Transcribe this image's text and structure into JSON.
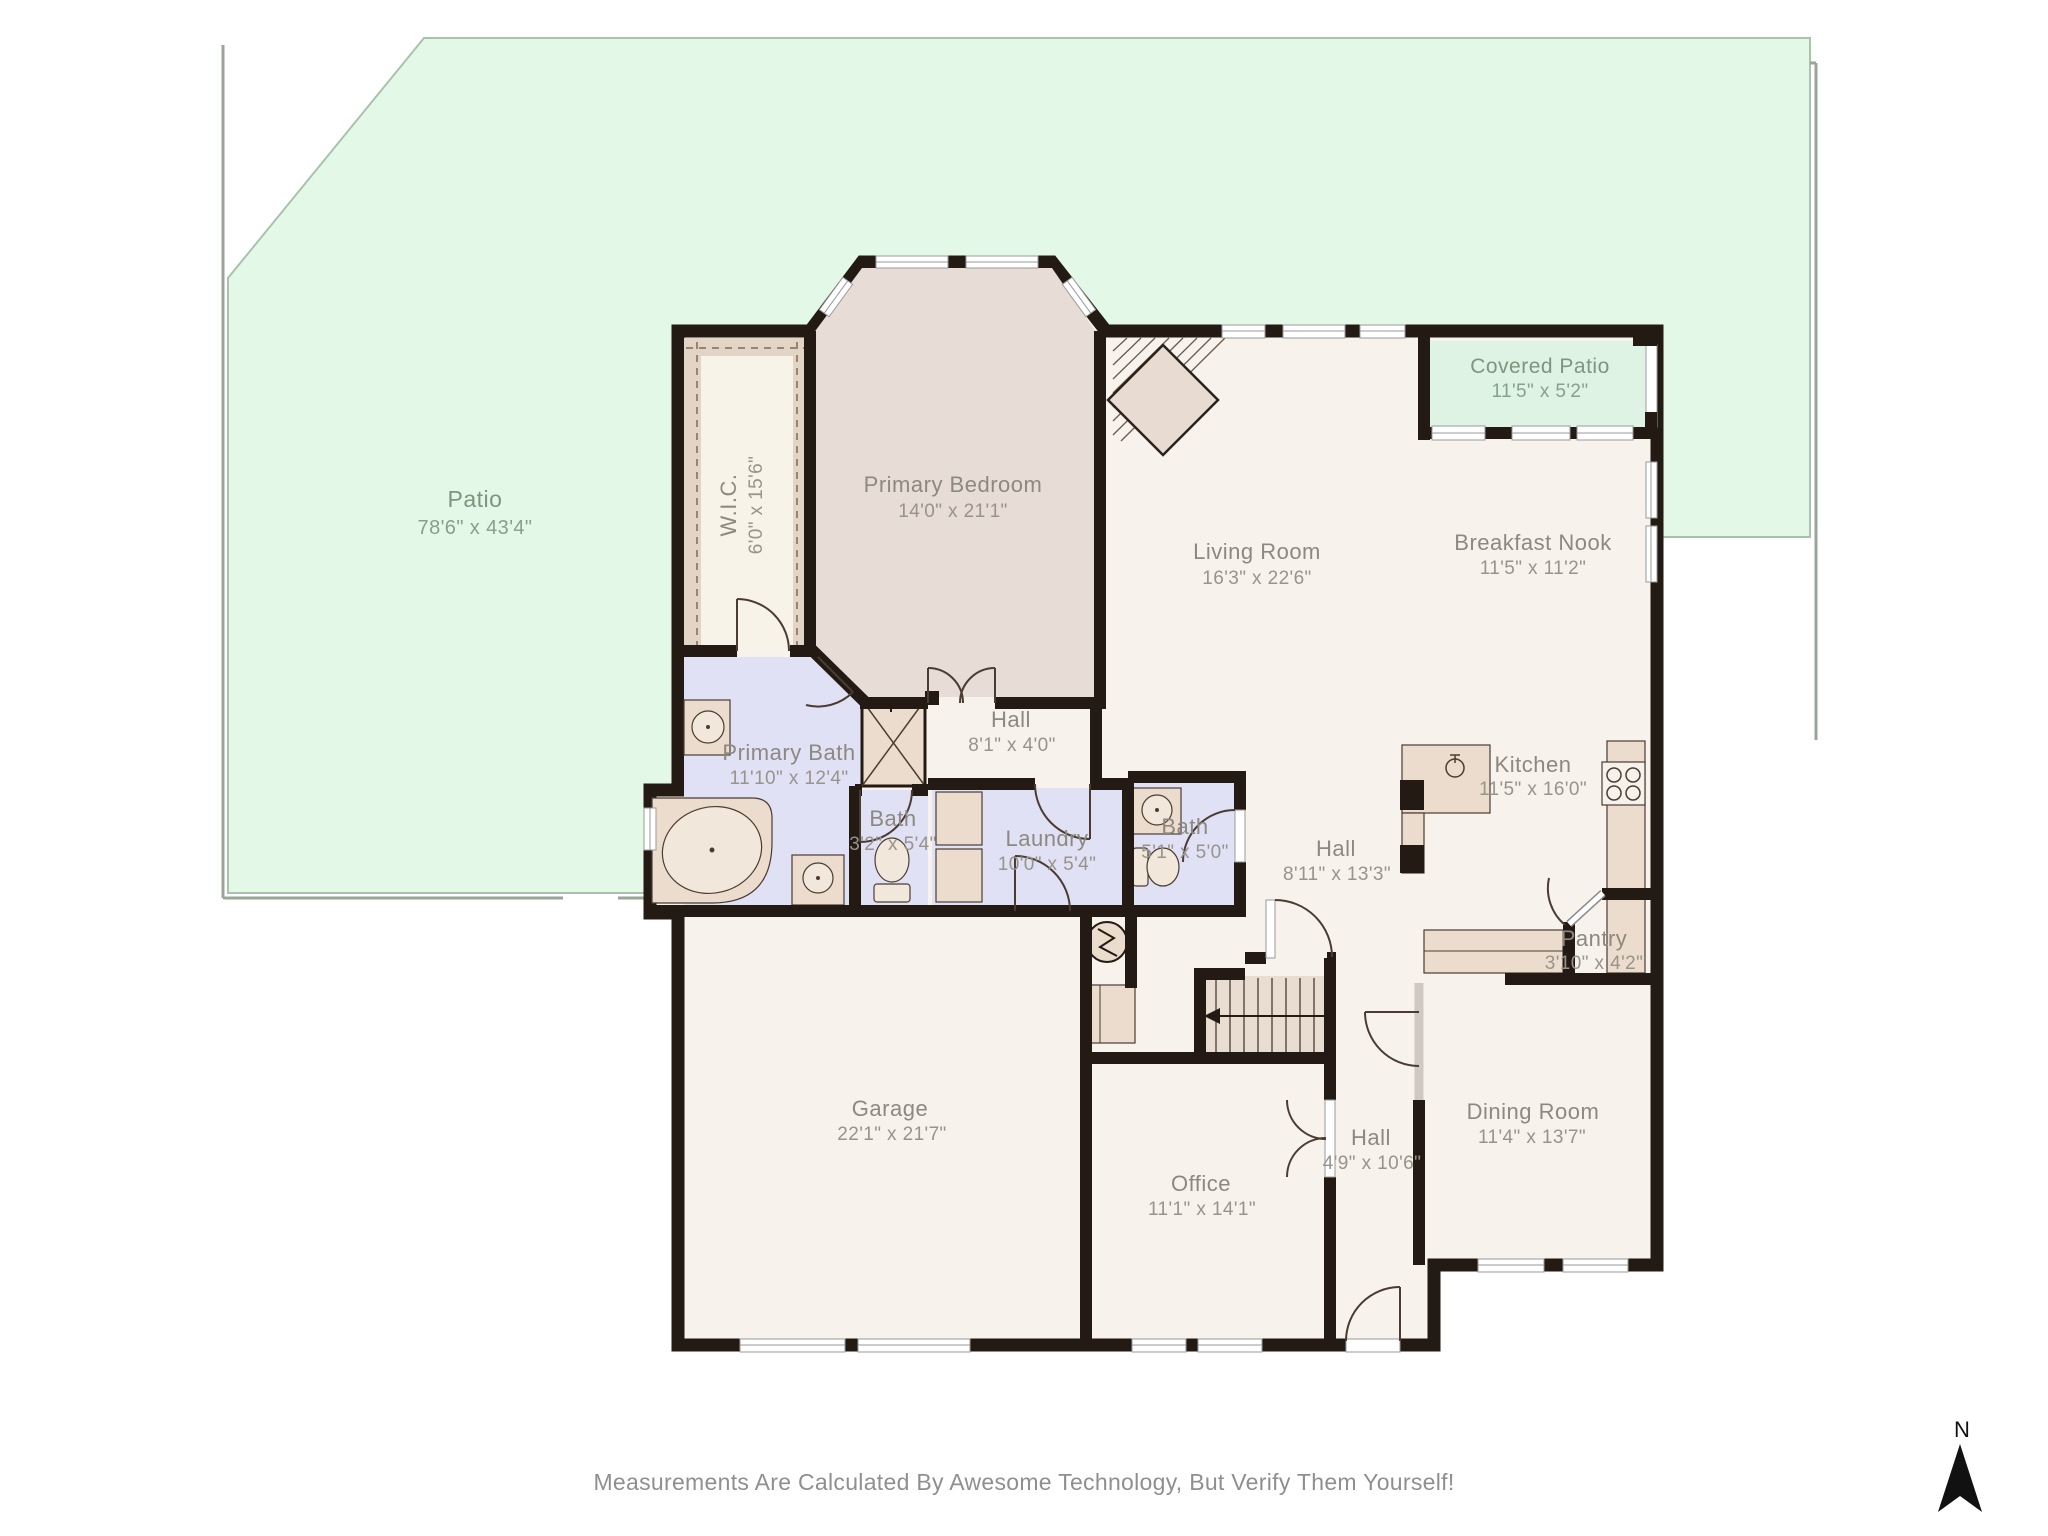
{
  "footer": {
    "disclaimer": "Measurements Are Calculated By Awesome Technology, But Verify Them Yourself!"
  },
  "compass": {
    "label": "N"
  },
  "rooms": {
    "patio": {
      "name": "Patio",
      "dims": "78'6\" x 43'4\""
    },
    "covered_patio": {
      "name": "Covered Patio",
      "dims": "11'5\" x 5'2\""
    },
    "wic": {
      "name": "W.I.C.",
      "dims": "6'0\" x 15'6\""
    },
    "primary_bedroom": {
      "name": "Primary Bedroom",
      "dims": "14'0\" x 21'1\""
    },
    "living_room": {
      "name": "Living Room",
      "dims": "16'3\" x 22'6\""
    },
    "breakfast_nook": {
      "name": "Breakfast Nook",
      "dims": "11'5\" x 11'2\""
    },
    "primary_bath": {
      "name": "Primary Bath",
      "dims": "11'10\" x 12'4\""
    },
    "hall_1": {
      "name": "Hall",
      "dims": "8'1\" x 4'0\""
    },
    "bath_1": {
      "name": "Bath",
      "dims": "3'2\" x 5'4\""
    },
    "laundry": {
      "name": "Laundry",
      "dims": "10'0\" x 5'4\""
    },
    "bath_2": {
      "name": "Bath",
      "dims": "5'1\" x 5'0\""
    },
    "hall_2": {
      "name": "Hall",
      "dims": "8'11\" x 13'3\""
    },
    "kitchen": {
      "name": "Kitchen",
      "dims": "11'5\" x 16'0\""
    },
    "pantry": {
      "name": "Pantry",
      "dims": "3'10\" x 4'2\""
    },
    "garage": {
      "name": "Garage",
      "dims": "22'1\" x 21'7\""
    },
    "office": {
      "name": "Office",
      "dims": "11'1\" x 14'1\""
    },
    "hall_3": {
      "name": "Hall",
      "dims": "4'9\" x 10'6\""
    },
    "dining_room": {
      "name": "Dining Room",
      "dims": "11'4\" x 13'7\""
    }
  },
  "colors": {
    "yard_green": "#e4f8e8",
    "covered_patio_green": "#dff3e5",
    "room_cream": "#f7f2eb",
    "bedroom_taupe": "#e7dcd6",
    "bath_lavender": "#e1e1f6",
    "fixture_tan": "#ecdccd",
    "wall_black": "#231a14"
  }
}
